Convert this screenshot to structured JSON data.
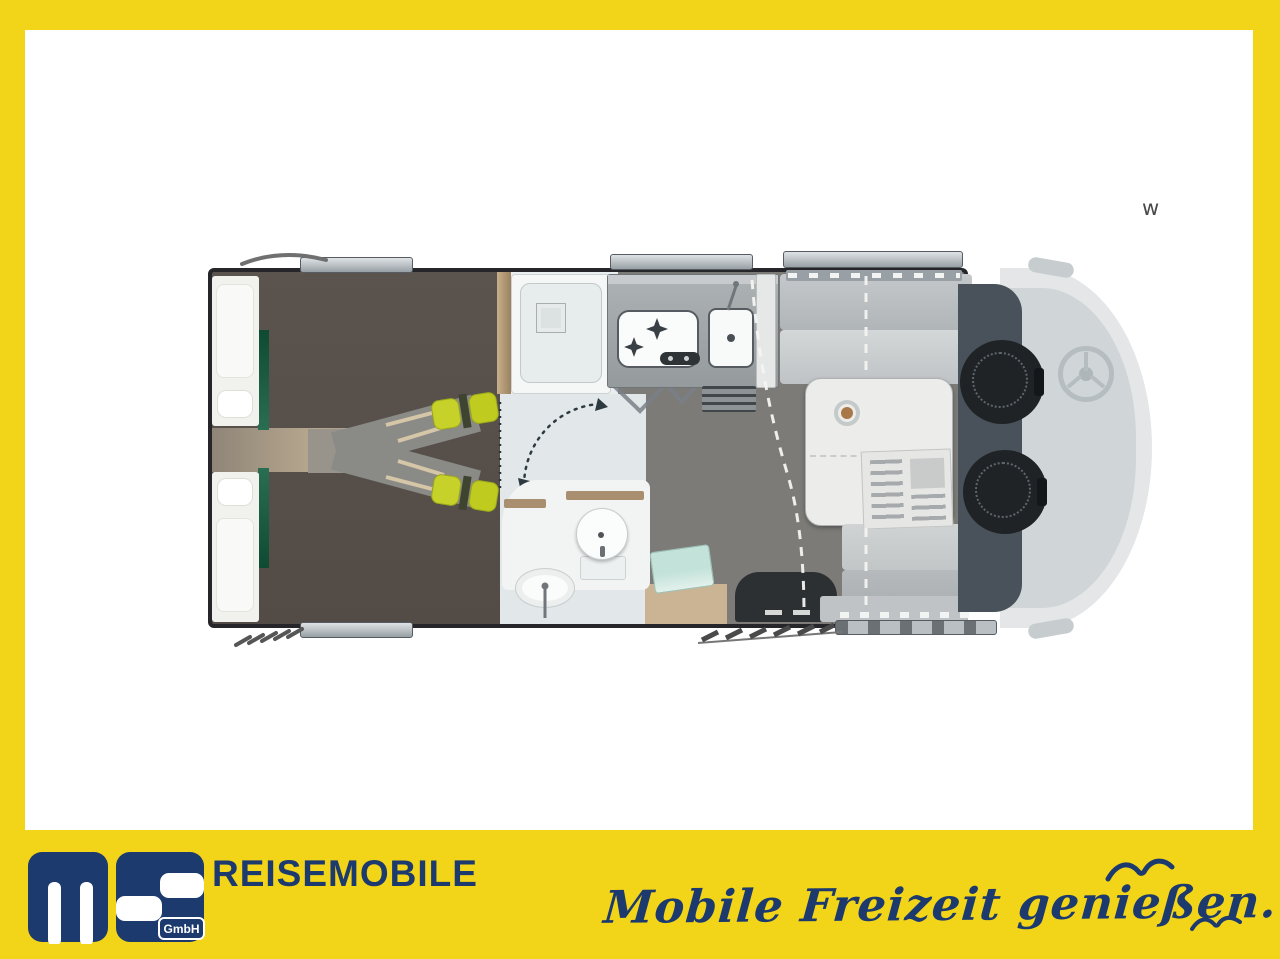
{
  "page": {
    "frame_color": "#F2D418",
    "canvas_color": "#FFFFFF"
  },
  "watermark": {
    "text": "w"
  },
  "branding": {
    "logo_monogram": "ms",
    "logo_suffix": "GmbH",
    "company": "REISEMOBILE",
    "tagline": "Mobile Freizeit genießen.",
    "colors": {
      "navy": "#1C3A6E",
      "yellow": "#F2D418"
    }
  },
  "floorplan": {
    "type": "motorhome-top-view",
    "orientation": {
      "rear": "left",
      "cab_front": "right"
    },
    "zones": [
      {
        "name": "rear-twin-single-beds"
      },
      {
        "name": "wardrobe-and-shower"
      },
      {
        "name": "bathroom-toilet-washbasin"
      },
      {
        "name": "kitchen-hob-and-sink"
      },
      {
        "name": "entry-door-with-step"
      },
      {
        "name": "dinette-table-and-benches"
      },
      {
        "name": "cab-with-swivel-seats"
      }
    ],
    "colors": {
      "bedroom_floor": "#57504B",
      "living_floor": "#7D7B77",
      "bath_floor": "#E2E7E9",
      "wood_trim": "#B99F7D",
      "accent_green": "#1D5F45",
      "cushion_green": "#C3CF1E",
      "bench_gray": "#C6CACB",
      "cab_dark": "#49525A",
      "seat_black": "#1F2326",
      "entry_mat_teal": "#BFDED6",
      "ghost_vehicle": "#CDD2D5"
    }
  }
}
